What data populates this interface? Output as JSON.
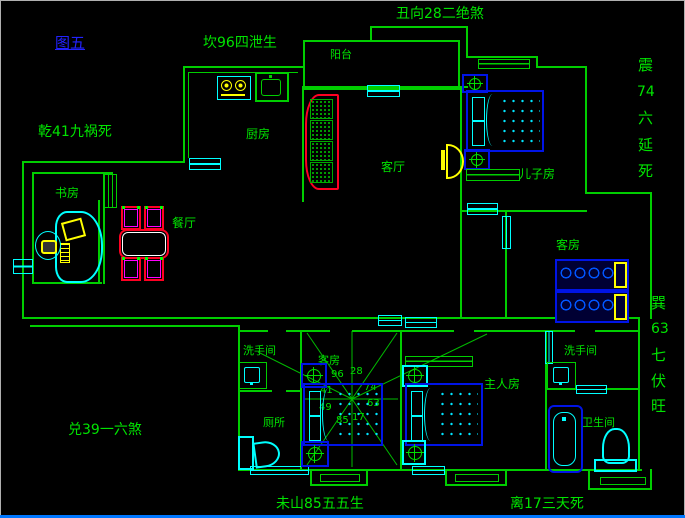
{
  "figure": {
    "label": "图五"
  },
  "annotations": {
    "top_left": "坎96四泄生",
    "top_center": "丑向28二绝煞",
    "left_upper": "乾41九祸死",
    "left_lower": "兑39一六煞",
    "bottom_left": "未山85五五生",
    "bottom_right": "离17三天死",
    "right_upper": [
      "震",
      "74",
      "六",
      "延",
      "死"
    ],
    "right_lower": [
      "巽",
      "63",
      "七",
      "伏",
      "旺"
    ]
  },
  "rooms": {
    "balcony": "阳台",
    "kitchen": "厨房",
    "living": "客厅",
    "sons_room": "儿子房",
    "study": "书房",
    "dining": "餐厅",
    "guest_room_right": "客房",
    "washroom_left": "洗手间",
    "toilet": "厕所",
    "guest_room_center": "客房",
    "master_room": "主人房",
    "washroom_right": "洗手间",
    "bathroom": "卫生间"
  },
  "compass": {
    "numbers": [
      "96",
      "28",
      "41",
      "74",
      "49",
      "63",
      "85",
      "17"
    ]
  },
  "colors": {
    "background": "#000000",
    "wall_green": "#00ce00",
    "text_green": "#00e400",
    "figure_blue": "#2222ff",
    "window_cyan": "#00ffff",
    "furniture_blue": "#0014e6",
    "accent_red": "#ff0022",
    "accent_magenta": "#ff00ff",
    "accent_yellow": "#ffff00",
    "bottom_bar_blue": "#0077ff"
  }
}
